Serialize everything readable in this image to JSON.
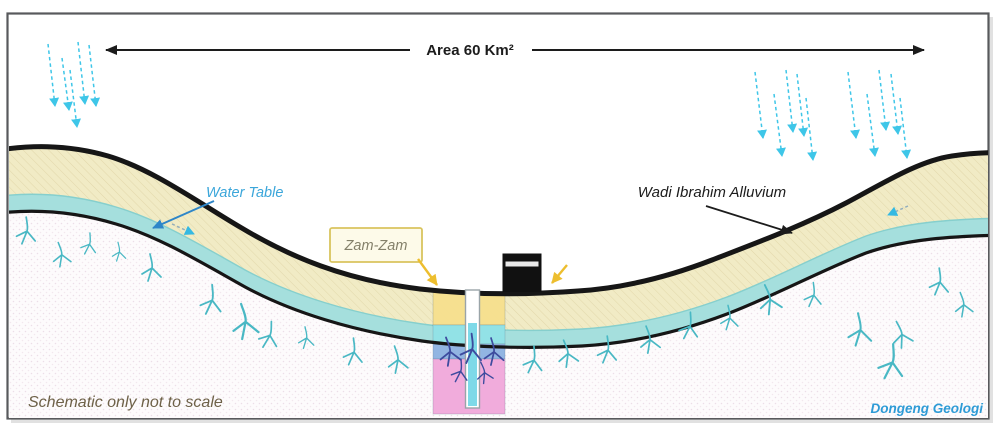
{
  "labels": {
    "area_extent": "Area 60 Km²",
    "water_table": "Water Table",
    "alluvium": "Wadi Ibrahim Alluvium",
    "well": "Zam-Zam",
    "note": "Schematic only not to scale",
    "credit": "Dongeng Geologi"
  },
  "colors": {
    "alluvium_cream": "#F1EBC5",
    "water_band_cyan": "#A5DFDD",
    "bedrock_base": "#FDFBFC",
    "well_overlay_yellow": "#F6DF8D",
    "well_overlay_cyan": "#92E2E6",
    "well_overlay_blue": "#92B5E2",
    "well_overlay_pink": "#F1ACDC",
    "well_water": "#7ED9E8",
    "fracture_teal": "#49B8C4",
    "fracture_navy": "#3D4B9E",
    "rain_cyan": "#3EC6E8",
    "pointer_yellow": "#EDBE2E",
    "label_blue": "#3BA6DA",
    "kaaba_black": "#111111",
    "surface_line": "#161616"
  }
}
